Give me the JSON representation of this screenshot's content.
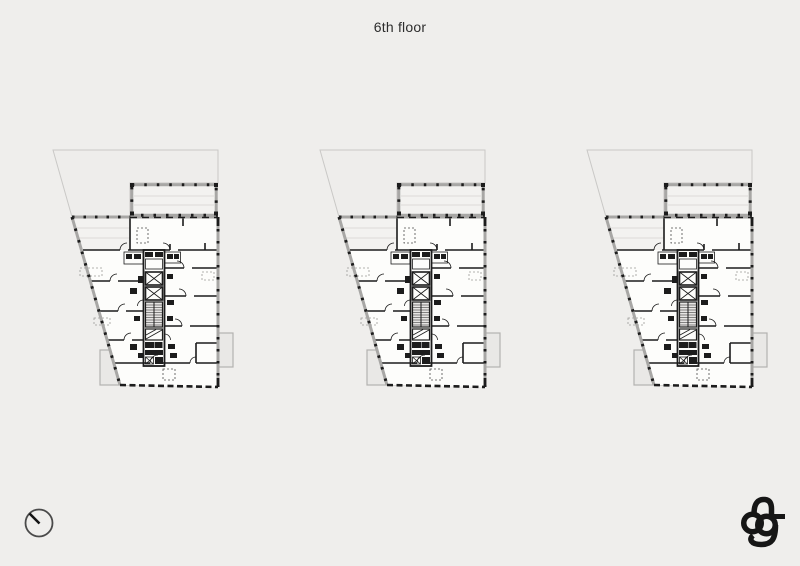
{
  "page": {
    "title": "6th floor"
  },
  "theme": {
    "bg": "#efeeec",
    "ink": "#1c1c1c",
    "paper": "#fdfdfb",
    "lightfill": "#f3f2f0",
    "faint": "#c9c8c6",
    "wallgray": "#a8a7a5",
    "balcony": "#b3b2b0",
    "balconyfill": "#e9e8e6",
    "soft": "#dcdbd9",
    "title": "#2d2d2d"
  },
  "plans": {
    "count": 3,
    "items": [
      {
        "id": "floor-plan-left",
        "label": "6th floor plan"
      },
      {
        "id": "floor-plan-center",
        "label": "6th floor plan"
      },
      {
        "id": "floor-plan-right",
        "label": "6th floor plan"
      }
    ]
  },
  "icons": {
    "north_arrow": "north-arrow-icon",
    "logo": "architects-ag-monogram"
  }
}
